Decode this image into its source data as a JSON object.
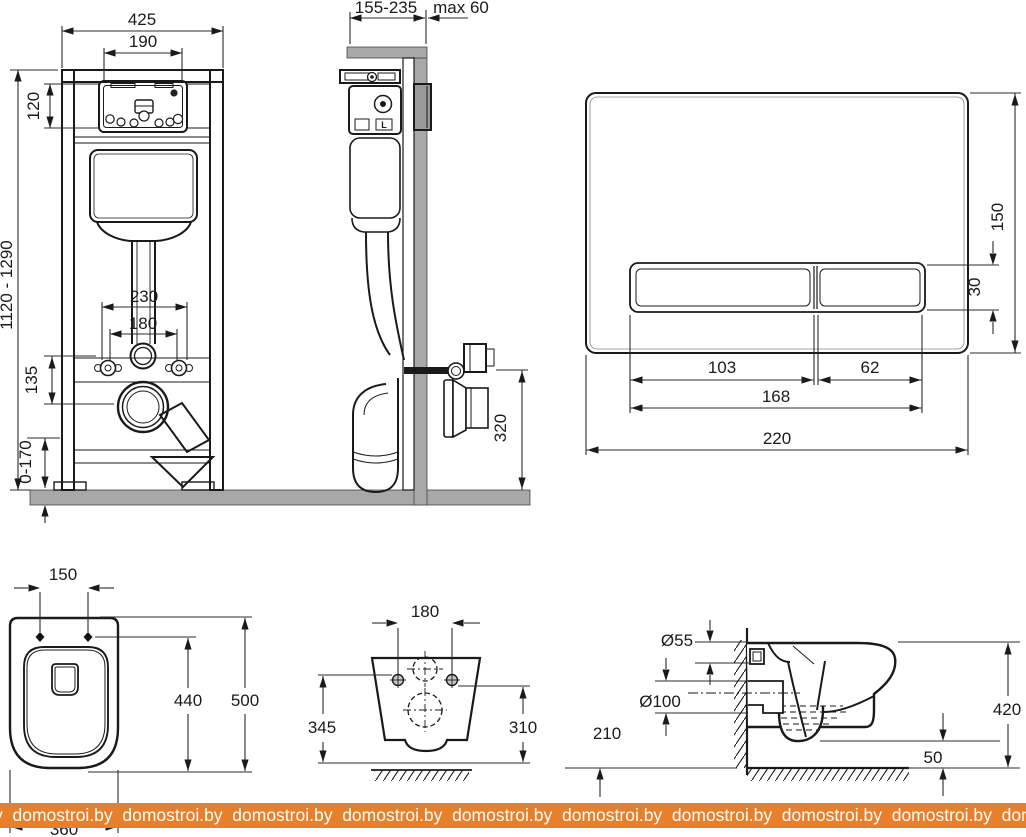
{
  "frame_front": {
    "total_width": "425",
    "opening_width": "190",
    "opening_height": "120",
    "height_range": "1120 - 1290",
    "hole_spacing_outer": "230",
    "hole_spacing_inner": "180",
    "outlet_offset": "135",
    "feet_range": "0-170"
  },
  "frame_side": {
    "depth_range": "155-235",
    "wall_max": "max 60",
    "outlet_height": "320",
    "tank_mark": "L"
  },
  "flush_plate": {
    "height": "150",
    "button_height": "30",
    "button_left_width": "103",
    "button_right_width": "62",
    "buttons_width": "168",
    "width": "220"
  },
  "bowl_top": {
    "hole_spacing": "150",
    "holes_to_front": "440",
    "total_depth": "500",
    "width": "360"
  },
  "bowl_rear": {
    "hole_spacing": "180",
    "left_height": "345",
    "right_height": "310"
  },
  "bowl_side": {
    "inlet_dia": "Ø55",
    "outlet_dia": "Ø100",
    "outlet_center_height": "210",
    "total_height": "420",
    "bottom_clearance": "50"
  },
  "watermark": {
    "color": "#e8802b",
    "text": "y  domostroi.by  domostroi.by  domostroi.by  domostroi.by  domostroi.by  domostroi.by  domostroi.by  domostroi.by  domostroi.by  domostroi.by"
  }
}
